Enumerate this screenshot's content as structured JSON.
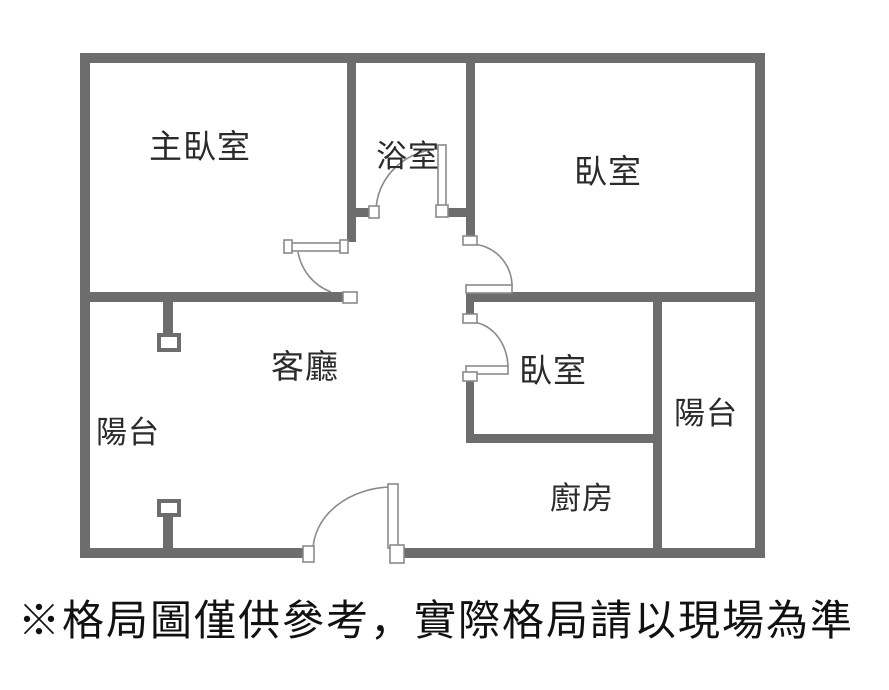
{
  "colors": {
    "wall": "#6d6d6d",
    "label": "#2b2b2b",
    "caption": "#111111",
    "background": "#ffffff"
  },
  "rooms": {
    "master_bedroom": "主臥室",
    "bathroom": "浴室",
    "bedroom_top_right": "臥室",
    "living_room": "客廳",
    "bedroom_middle": "臥室",
    "balcony_left": "陽台",
    "balcony_right": "陽台",
    "kitchen": "廚房"
  },
  "caption": "※格局圖僅供參考，實際格局請以現場為準"
}
